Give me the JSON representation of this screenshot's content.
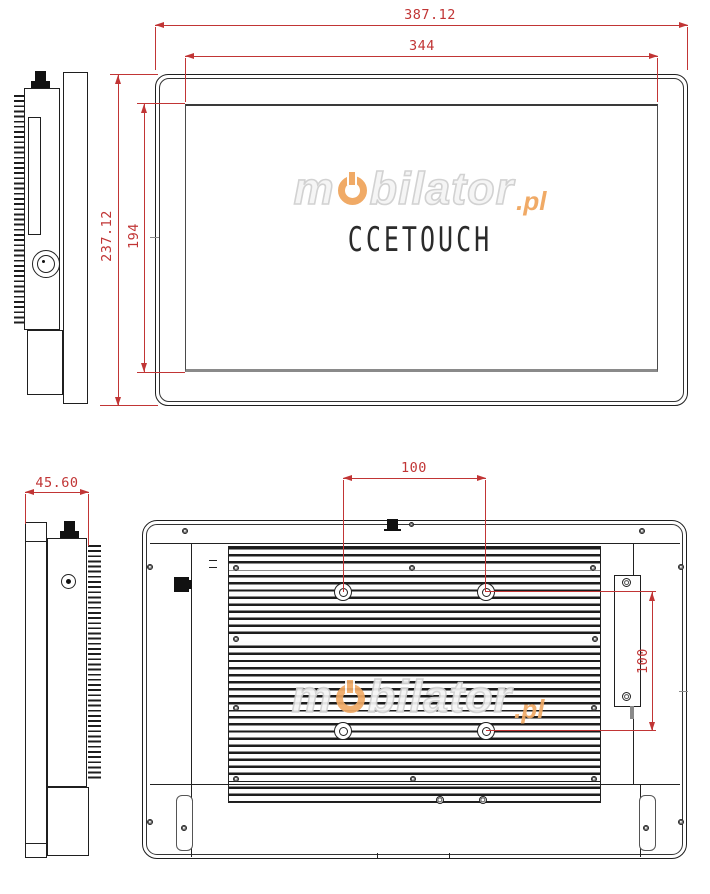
{
  "drawing": {
    "type": "technical-dimension-drawing",
    "views": [
      "side-left-top",
      "front",
      "side-left-bottom",
      "rear"
    ]
  },
  "branding": {
    "screen_logo": "CCETOUCH",
    "watermark": {
      "prefix": "m",
      "body": "bilator",
      "suffix": ".pl"
    }
  },
  "dimensions": {
    "front_outer_width": "387.12",
    "front_screen_width": "344",
    "front_outer_height": "237.12",
    "front_screen_height": "194",
    "side_depth": "45.60",
    "vesa_horizontal": "100",
    "vesa_vertical": "100"
  },
  "colors": {
    "dimension_red": "#c13535",
    "line_black": "#1f1f1f",
    "watermark_orange": "#f0aa66",
    "watermark_gray": "#d2d2d2"
  }
}
